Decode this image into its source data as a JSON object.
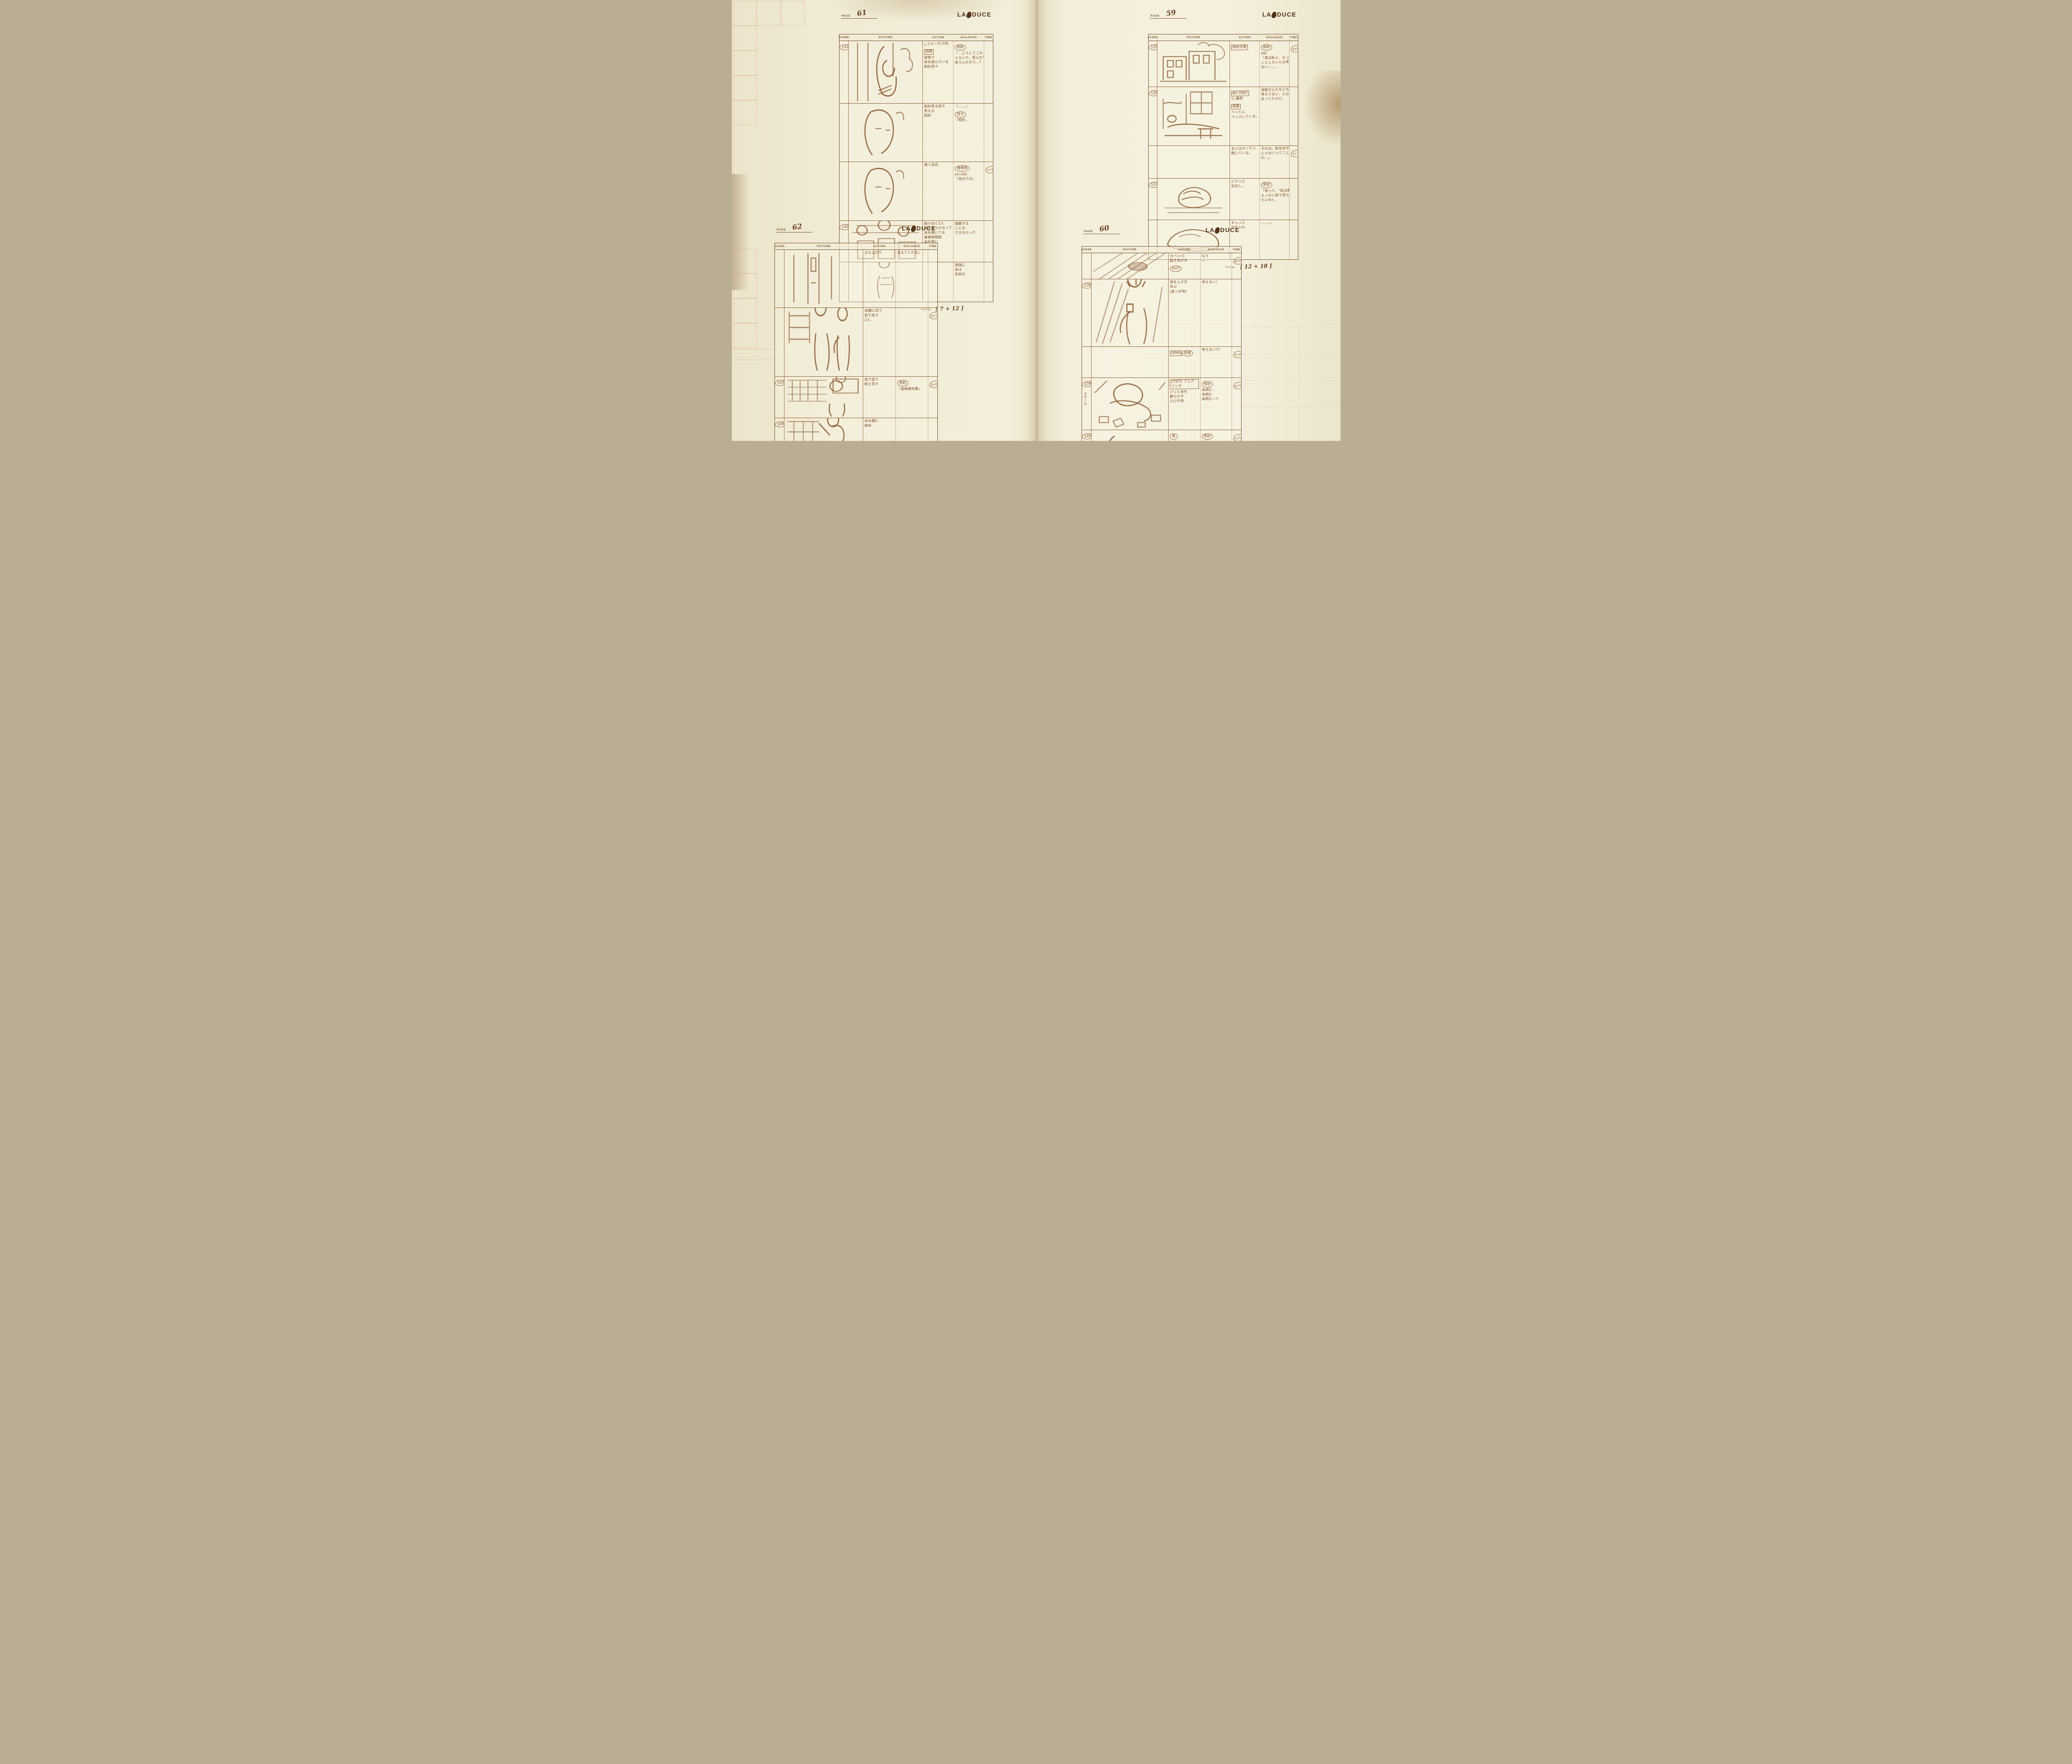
{
  "page_label": "PAGE",
  "total_label": "TOTAL",
  "logo": {
    "left": "LA",
    "right": "DUCE"
  },
  "columns": [
    "SCENE",
    "PICTURE",
    "ACTION",
    "DIALOGUE",
    "TIME"
  ],
  "palette": {
    "paper": "#f0e9d2",
    "ink": "#6f4522",
    "pencil": "#8a5a33",
    "mark_pink": "#d89a8e"
  },
  "sheets": [
    {
      "page_number": "61",
      "total_value": "[ 7 + 12 ]",
      "rows": [
        {
          "scene": "141",
          "sketch": "window-read",
          "action": [
            {
              "style": "plain",
              "text": "△フォーカスIN"
            },
            {
              "style": "box",
              "text": "回想"
            },
            {
              "style": "plain",
              "text": "部室で"
            },
            {
              "style": "plain",
              "text": "本を読んでいる"
            },
            {
              "style": "plain",
              "text": "和紗百々"
            }
          ],
          "dialogue": [
            {
              "style": "circle",
              "text": "和紗"
            },
            {
              "style": "plain",
              "text": "「…どうしてこれ"
            },
            {
              "style": "plain",
              "text": "ぐらいで、死んだりって"
            },
            {
              "style": "plain",
              "text": "思うんだろう…?"
            }
          ],
          "time": null
        },
        {
          "scene": null,
          "sketch": "face",
          "action": [
            {
              "style": "plain",
              "text": "和紗見る百々"
            },
            {
              "style": "plain",
              "text": "考える"
            },
            {
              "style": "plain",
              "text": "和紗"
            }
          ],
          "dialogue": [
            {
              "style": "plain",
              "text": "「……」"
            },
            {
              "style": "circle",
              "text": "百々"
            },
            {
              "style": "plain",
              "text": "「和紗…"
            }
          ],
          "time": null
        },
        {
          "scene": null,
          "sketch": "face2",
          "action": [
            {
              "style": "plain",
              "text": "導く反応"
            }
          ],
          "dialogue": [
            {
              "style": "circle",
              "text": "曾根崎"
            },
            {
              "style": "plain",
              "text": "(4+00)"
            },
            {
              "style": "plain",
              "text": "「自分では」"
            }
          ],
          "time": "7+12"
        },
        {
          "scene": "142",
          "sketch": "train",
          "action": [
            {
              "style": "plain",
              "text": "振り向く2人"
            },
            {
              "style": "plain",
              "text": "何かそうかなって"
            },
            {
              "style": "plain",
              "text": "本を開いてる"
            },
            {
              "style": "plain",
              "text": "曾根崎想起"
            },
            {
              "style": "plain",
              "text": "本を閉じ"
            }
          ],
          "dialogue": [
            {
              "style": "plain",
              "text": "理解する"
            },
            {
              "style": "plain",
              "text": "ことの"
            },
            {
              "style": "plain",
              "text": "できなかった"
            }
          ],
          "time": null
        },
        {
          "scene": null,
          "sketch": "standing",
          "action": [],
          "dialogue": [
            {
              "style": "plain",
              "text": "感情に"
            },
            {
              "style": "plain",
              "text": "本は"
            },
            {
              "style": "plain",
              "text": "名前を"
            }
          ],
          "time": null
        }
      ]
    },
    {
      "page_number": "59",
      "total_value": "[ 12 + 18 ]",
      "rows": [
        {
          "scene": "135",
          "sketch": "house",
          "action": [
            {
              "style": "box",
              "text": "和紗の家"
            }
          ],
          "dialogue": [
            {
              "style": "circle",
              "text": "和紗"
            },
            {
              "style": "plain",
              "text": "(M)"
            },
            {
              "style": "plain",
              "text": "「泉は私と、えっちい"
            },
            {
              "style": "plain",
              "text": "ことしたいとは考えて"
            },
            {
              "style": "plain",
              "text": "ない…、、、"
            }
          ],
          "time": "3+09"
        },
        {
          "scene": "136",
          "sketch": "bedroom",
          "action": [
            {
              "style": "box",
              "text": "BG ONLY"
            },
            {
              "style": "plain",
              "text": "½ 兼用"
            },
            {
              "style": "box",
              "text": "部屋"
            },
            {
              "style": "plain",
              "text": "ベットに"
            },
            {
              "style": "plain",
              "text": "つっぷしている。"
            }
          ],
          "dialogue": [
            {
              "style": "plain",
              "text": "浅田さんたちとも"
            },
            {
              "style": "plain",
              "text": "考えてない、とは"
            },
            {
              "style": "plain",
              "text": "言ってたけど、"
            }
          ],
          "time": null
        },
        {
          "scene": null,
          "sketch": null,
          "action": [
            {
              "style": "plain",
              "text": "まどはカーテン"
            },
            {
              "style": "plain",
              "text": "閉じている。"
            }
          ],
          "dialogue": [
            {
              "style": "plain",
              "text": "それは、私を好き"
            },
            {
              "style": "plain",
              "text": "じゃないってことなの"
            },
            {
              "style": "plain",
              "text": "か…」"
            }
          ],
          "time": "7+18"
        },
        {
          "scene": "137",
          "sketch": "bed-sleep",
          "action": [
            {
              "style": "plain",
              "text": "ピクッと"
            },
            {
              "style": "plain",
              "text": "反応し。"
            }
          ],
          "dialogue": [
            {
              "style": "circle",
              "text": "和紗"
            },
            {
              "style": "plain",
              "text": "「待って、〝私は泉に"
            },
            {
              "style": "plain",
              "text": "えっちい目で見られ"
            },
            {
              "style": "plain",
              "text": "たいの?〟"
            }
          ],
          "time": null
        },
        {
          "scene": null,
          "sketch": "pillow",
          "action": [
            {
              "style": "plain",
              "text": "ギュッと"
            },
            {
              "style": "plain",
              "text": "力を入れ"
            }
          ],
          "dialogue": [
            {
              "style": "plain",
              "text": "、、、、、」"
            }
          ],
          "time": null
        }
      ]
    },
    {
      "page_number": "62",
      "total_value": "[ 7 + 18 ]",
      "rows": [
        {
          "scene": null,
          "sketch": "door",
          "action": [
            {
              "style": "plain",
              "text": "立ち上がり"
            }
          ],
          "dialogue": [
            {
              "style": "plain",
              "text": "与えてくれる」"
            }
          ],
          "time": null
        },
        {
          "scene": null,
          "sketch": "duo-shelf",
          "action": [
            {
              "style": "plain",
              "text": "本棚に向う"
            },
            {
              "style": "plain",
              "text": "目で追う"
            },
            {
              "style": "plain",
              "text": "2人."
            }
          ],
          "dialogue": [],
          "time": "5+18"
        },
        {
          "scene": "143",
          "sketch": "shelf-inset",
          "action": [
            {
              "style": "plain",
              "text": "目で追う"
            },
            {
              "style": "plain",
              "text": "和と百々"
            }
          ],
          "dialogue": [
            {
              "style": "circle",
              "text": "和紗"
            },
            {
              "style": "plain",
              "text": "「曾根崎先輩」"
            }
          ],
          "time": "2+00"
        },
        {
          "scene": "144",
          "sketch": "reach-shelf",
          "action": [
            {
              "style": "plain",
              "text": "本を棚に"
            },
            {
              "style": "plain",
              "text": "納め"
            }
          ],
          "dialogue": [],
          "time": null
        },
        {
          "scene": null,
          "sketch": "profile",
          "action": [],
          "dialogue": [
            {
              "style": "circle",
              "text": "曾根崎"
            },
            {
              "style": "plain",
              "text": "「本に名付けられた"
            },
            {
              "style": "plain",
              "text": "感情を、もう一度"
            },
            {
              "style": "plain",
              "text": "自分の中に取り"
            },
            {
              "style": "plain",
              "text": "入れた時、"
            }
          ],
          "time": null
        }
      ]
    },
    {
      "page_number": "60",
      "total_value": "[ 12 + 17 ]",
      "rows": [
        {
          "scene": null,
          "sketch": "rush-feet",
          "action": [
            {
              "style": "plain",
              "text": "ガバッ!と"
            },
            {
              "style": "plain",
              "text": "起きあがる"
            },
            {
              "style": "circle",
              "text": "OUT"
            }
          ],
          "dialogue": [
            {
              "style": "plain",
              "text": "もう"
            },
            {
              "style": "plain",
              "text": "—"
            }
          ],
          "time": "6+12"
        },
        {
          "scene": "138",
          "sketch": "scream",
          "action": [
            {
              "style": "plain",
              "text": "耳をふさぎ"
            },
            {
              "style": "plain",
              "text": "叫ぶ"
            },
            {
              "style": "plain",
              "text": "(息つぎ有)"
            }
          ],
          "dialogue": [
            {
              "style": "plain",
              "text": "考えない!"
            }
          ],
          "time": null
        },
        {
          "scene": null,
          "sketch": null,
          "action": [
            {
              "style": "box",
              "text": "QPAN"
            },
            {
              "style": "circle",
              "text": "読者"
            }
          ],
          "dialogue": [
            {
              "style": "plain",
              "text": "考えない!!!"
            }
          ],
          "time": "2+00"
        },
        {
          "scene": "139",
          "sketch": "collapse",
          "side_note": "スチール",
          "action": [
            {
              "style": "box",
              "text": "2T打ち フェアリング"
            },
            {
              "style": "plain",
              "text": "バッと本を"
            },
            {
              "style": "plain",
              "text": "散らかす"
            },
            {
              "style": "plain",
              "text": "ひびき有"
            }
          ],
          "dialogue": [
            {
              "style": "circle",
              "text": "和紗"
            },
            {
              "style": "plain",
              "text": "本読む"
            },
            {
              "style": "plain",
              "text": "本読む"
            },
            {
              "style": "plain",
              "text": "本読む—!!"
            }
          ],
          "time": "8+18"
        },
        {
          "scene": "140",
          "sketch": "face-hand",
          "action": [
            {
              "style": "circle",
              "text": "泉"
            },
            {
              "style": "plain",
              "text": "和紗"
            },
            {
              "style": "plain",
              "text": "ハッとする"
            },
            {
              "style": "plain",
              "text": "和紗"
            }
          ],
          "dialogue": [
            {
              "style": "circle",
              "text": "和紗"
            },
            {
              "style": "plain",
              "text": "「あ……」"
            }
          ],
          "time": "1+12"
        }
      ]
    }
  ]
}
